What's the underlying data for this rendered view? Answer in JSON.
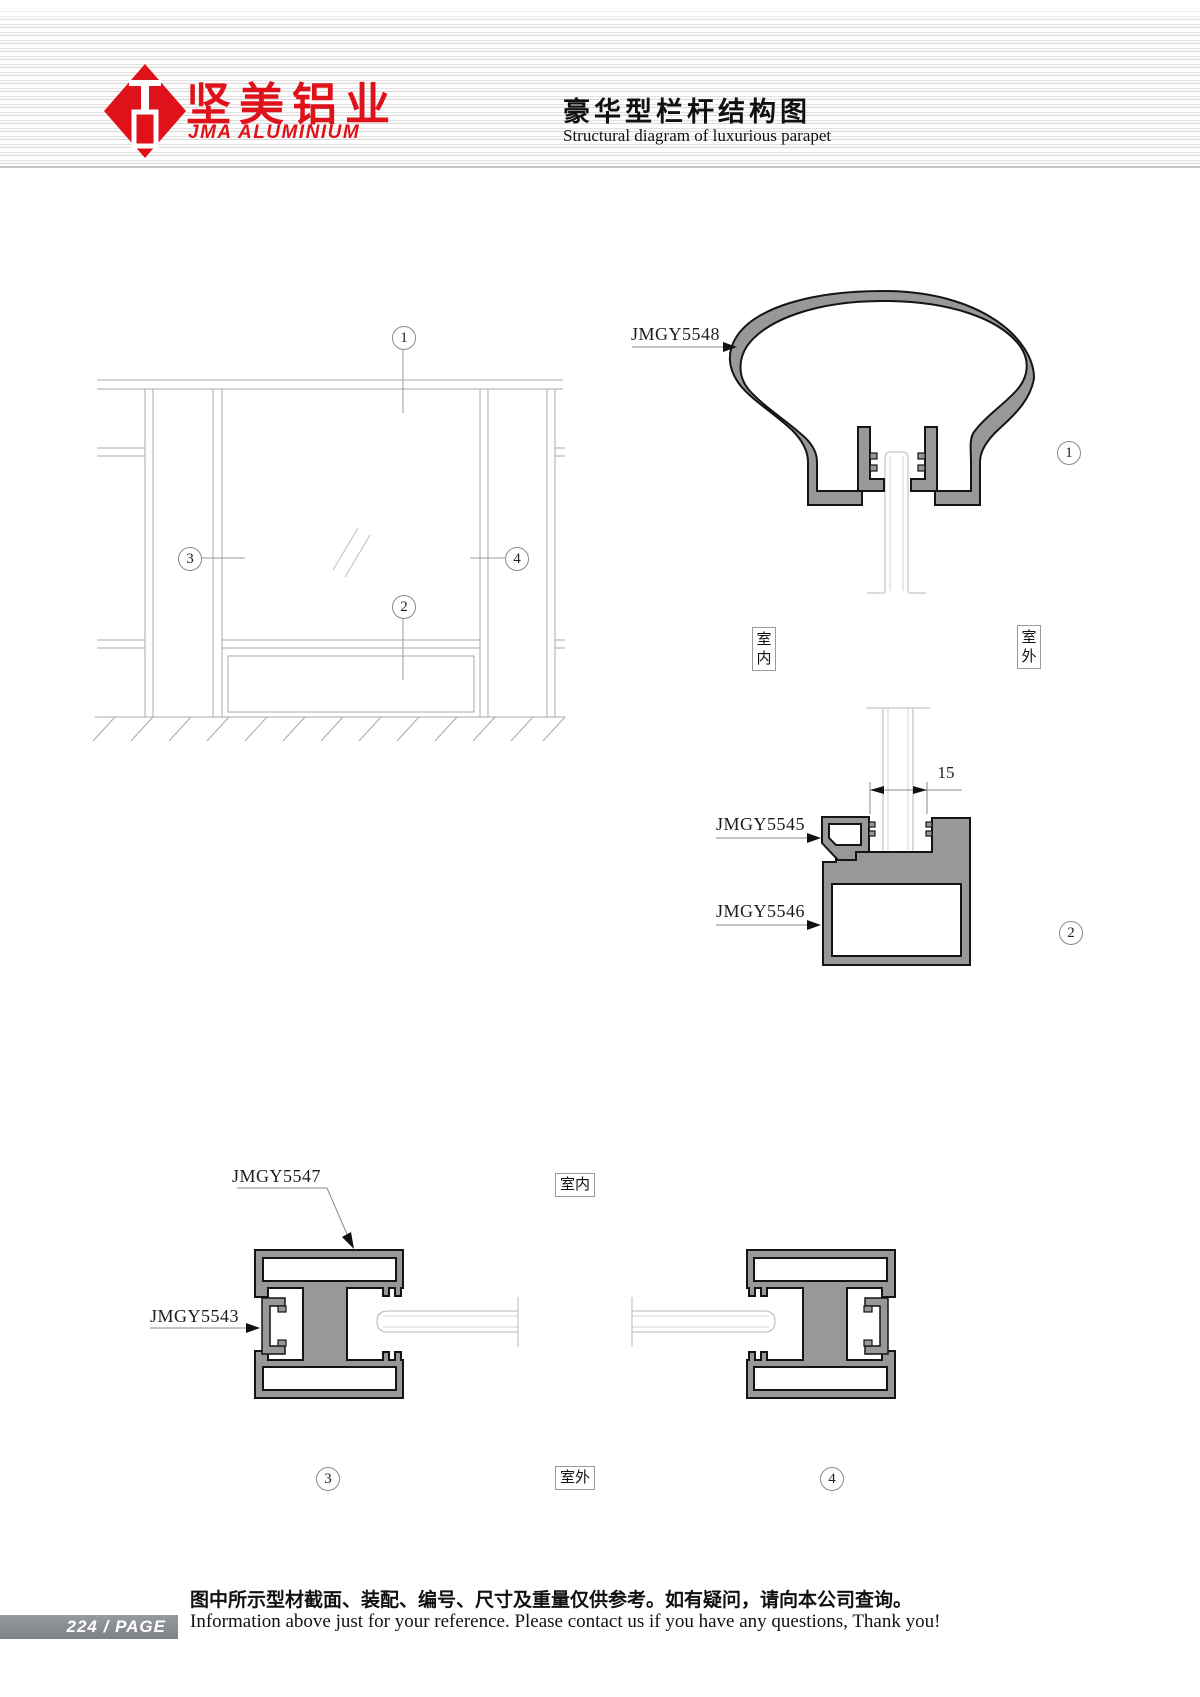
{
  "header": {
    "company_cn": "坚美铝业",
    "company_en": "JMA ALUMINIUM",
    "title_cn": "豪华型栏杆结构图",
    "title_en": "Structural diagram of luxurious parapet"
  },
  "diagram": {
    "profile_labels": {
      "handrail": "JMGY5548",
      "glazing_bead": "JMGY5545",
      "bottom_rail": "JMGY5546",
      "post": "JMGY5547",
      "post_clip": "JMGY5543"
    },
    "dimension_15": "15",
    "location_labels": {
      "indoor": "室内",
      "outdoor": "室外"
    },
    "callouts": {
      "n1": "1",
      "n2": "2",
      "n3": "3",
      "n4": "4"
    }
  },
  "footer": {
    "page_number": "224",
    "page_separator": "/",
    "page_label": "PAGE",
    "note_cn": "图中所示型材截面、装配、编号、尺寸及重量仅供参考。如有疑问，请向本公司查询。",
    "note_en": "Information above just for your reference. Please contact us if you have any questions, Thank you!"
  },
  "colors": {
    "brand_red": "#df1219",
    "profile_fill": "#98989a",
    "line_gray": "#a8a8a8",
    "badge_bg": "#898d91"
  }
}
